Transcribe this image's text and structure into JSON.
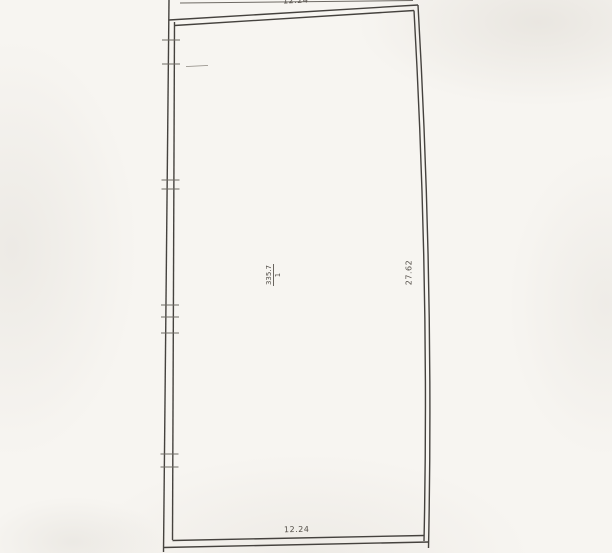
{
  "colors": {
    "paper": "#f7f5f1",
    "ink": "#45423e",
    "faint_ink": "#7a756e"
  },
  "floor_plan": {
    "dimensions": {
      "top": "12.24",
      "bottom": "12.24",
      "right": "27.62"
    },
    "room": {
      "area": "335.7",
      "number": "1"
    }
  }
}
